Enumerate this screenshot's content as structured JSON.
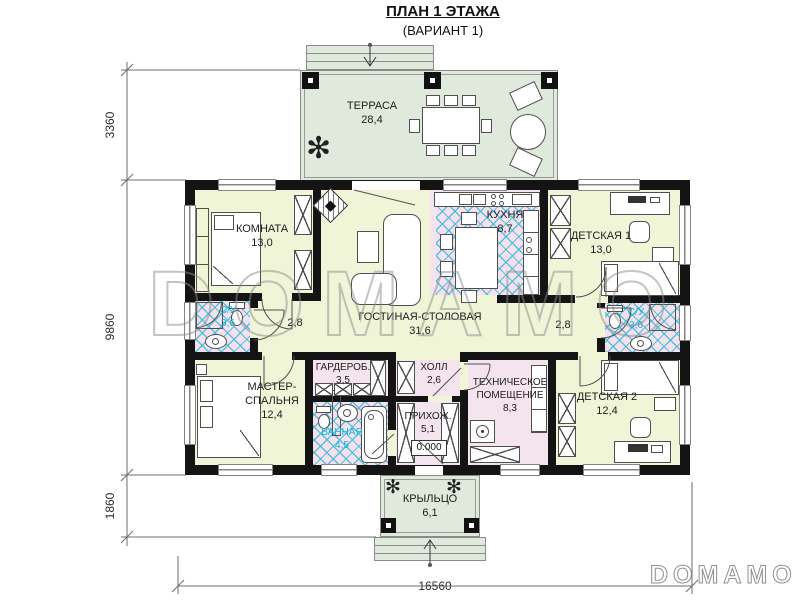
{
  "title": {
    "line1": "ПЛАН 1 ЭТАЖА",
    "line2": "(ВАРИАНТ 1)"
  },
  "watermark": {
    "center": "DOMAMO",
    "corner": "DOMAMO"
  },
  "icons": {
    "plant_glyph": "✻"
  },
  "dimensions": {
    "terrace_depth": "3360",
    "house_depth": "9860",
    "porch_depth": "1860",
    "total_width": "16560"
  },
  "rooms": {
    "terrace": {
      "name": "ТЕРРАСА",
      "area": "28,4"
    },
    "bedroom": {
      "name": "КОМНАТА",
      "area": "13,0"
    },
    "kitchen": {
      "name": "КУХНЯ",
      "area": "8,7"
    },
    "kids1": {
      "name": "ДЕТСКАЯ 1",
      "area": "13,0"
    },
    "living": {
      "name": "ГОСТИНАЯ-СТОЛОВАЯ",
      "area": "31,6"
    },
    "wc_left": {
      "name": "С/У",
      "area": "3,6"
    },
    "wc_right": {
      "name": "С/У",
      "area": "3,6"
    },
    "hall_width_left": "2,8",
    "hall_width_right": "2,8",
    "master": {
      "name_line1": "МАСТЕР-",
      "name_line2": "СПАЛЬНЯ",
      "area": "12,4"
    },
    "wardrobe": {
      "name": "ГАРДЕРОБ.",
      "area": "3,5"
    },
    "bathroom": {
      "name": "ВАННАЯ",
      "area": "4,5"
    },
    "hall": {
      "name": "ХОЛЛ",
      "area": "2,6"
    },
    "entry": {
      "name": "ПРИХОЖ.",
      "area": "5,1",
      "level_mark": "0.000"
    },
    "tech": {
      "name_line1": "ТЕХНИЧЕСКОЕ",
      "name_line2": "ПОМЕЩЕНИЕ",
      "area": "8,3"
    },
    "kids2": {
      "name": "ДЕТСКАЯ 2",
      "area": "12,4"
    },
    "porch": {
      "name": "КРЫЛЬЦО",
      "area": "6,1"
    }
  }
}
